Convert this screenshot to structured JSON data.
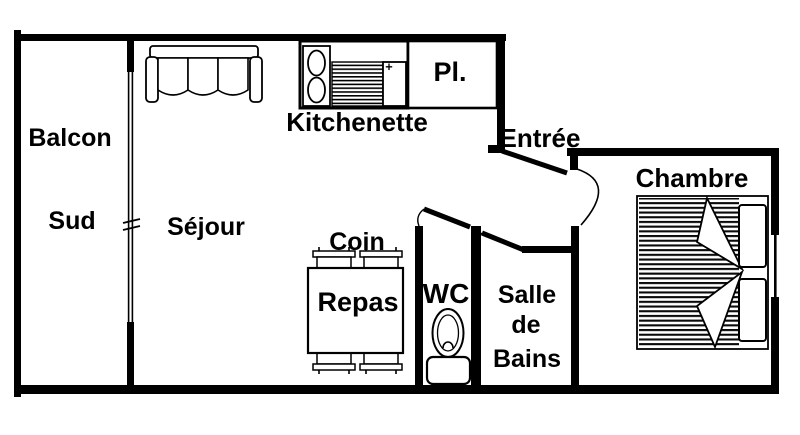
{
  "plan": {
    "colors": {
      "wall": "#000000",
      "background": "#ffffff"
    },
    "rooms": {
      "balcon": {
        "line1": "Balcon",
        "line2": "Sud"
      },
      "sejour": {
        "label": "Séjour"
      },
      "kitchenette": {
        "label": "Kitchenette"
      },
      "placard": {
        "label": "Pl."
      },
      "entree": {
        "label": "Entrée"
      },
      "chambre": {
        "label": "Chambre"
      },
      "coin_repas": {
        "line1": "Coin",
        "line2": "Repas"
      },
      "wc": {
        "label": "WC"
      },
      "salle_de_bains": {
        "line1": "Salle",
        "line2": "de",
        "line3": "Bains"
      }
    },
    "icons": {
      "sofa": "sofa-icon",
      "stove": "stove-two-burners-icon",
      "drainer": "sink-drainer-icon",
      "sink": "sink-basin-icon",
      "dining_table": "dining-table-icon",
      "chairs": "chair-icon",
      "toilet": "toilet-icon",
      "bed": "double-bed-icon",
      "balcony_window": "window-icon",
      "bedroom_window": "window-icon",
      "doors": "door-swing-icon"
    }
  }
}
